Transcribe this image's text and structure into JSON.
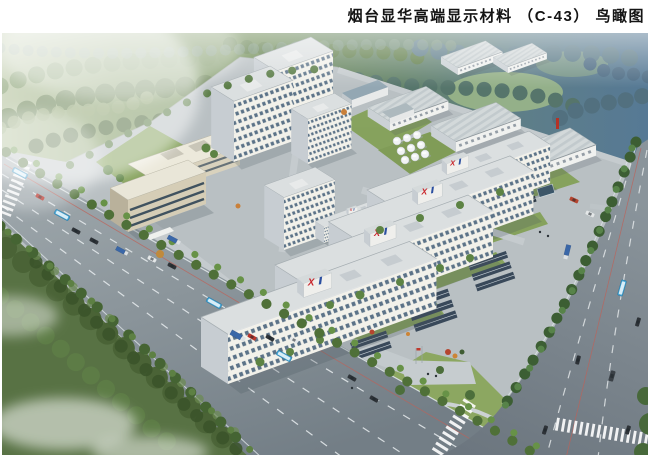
{
  "header": {
    "title": "烟台显华高端显示材料 （C-43） 鸟瞰图"
  },
  "scene": {
    "logo_mark": "X",
    "colors": {
      "forest_green": "#6f8c55",
      "distant_blue": "#5f7e94",
      "road_gray": "#8a949a",
      "building_white": "#f2f1ea",
      "lawn_green": "#84a158",
      "logo_red": "#c9252b",
      "logo_blue": "#2b4fa0",
      "autumn_accent": "#c9803a"
    }
  }
}
